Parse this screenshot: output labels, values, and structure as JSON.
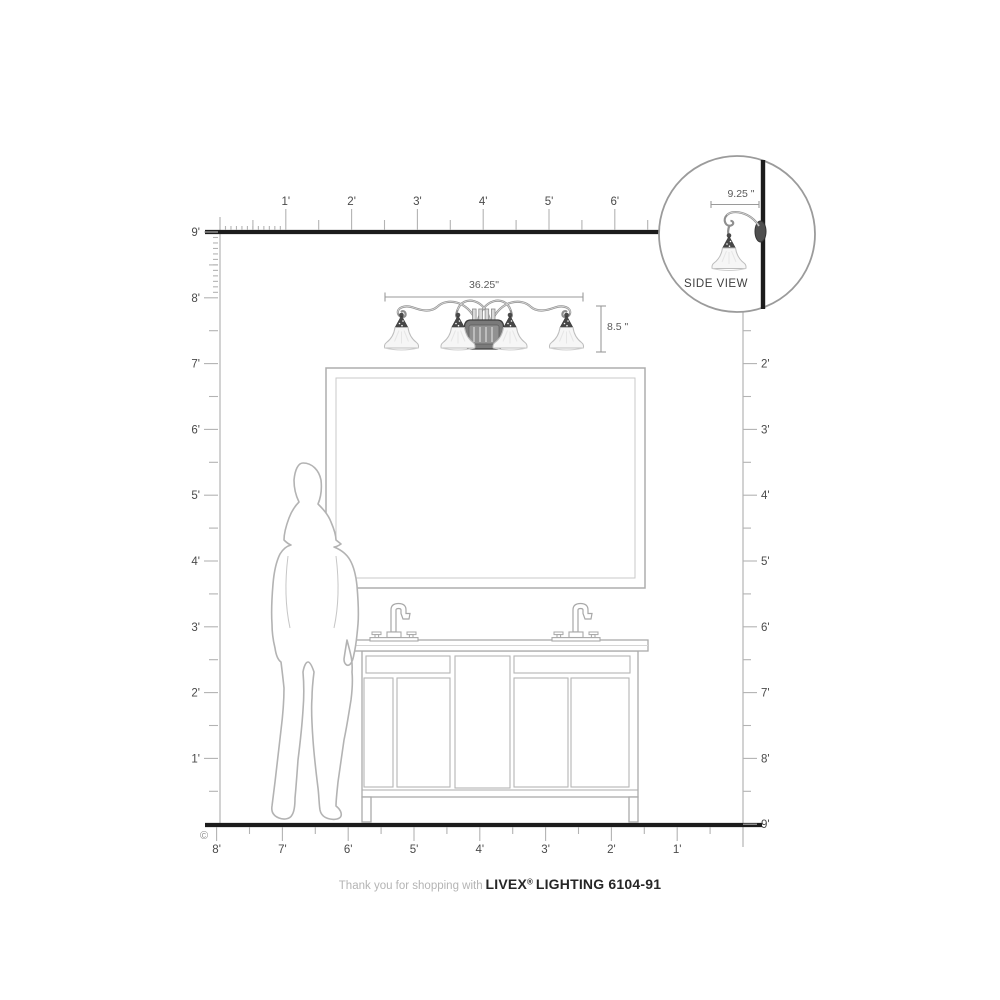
{
  "page": {
    "background": "#ffffff",
    "wall_line_color": "#1c1c1c",
    "ruler_line_color": "#b3b3b3",
    "ruler_label_color": "#4a4a4a",
    "drawing_line_color": "#ababab",
    "dim_text_color": "#5a5a5a"
  },
  "rulers": {
    "top": {
      "labels": [
        "1'",
        "2'",
        "3'",
        "4'",
        "5'",
        "6'"
      ]
    },
    "left": {
      "labels": [
        "9'",
        "8'",
        "7'",
        "6'",
        "5'",
        "4'",
        "3'",
        "2'",
        "1'"
      ]
    },
    "right": {
      "labels": [
        "2'",
        "3'",
        "4'",
        "5'",
        "6'",
        "7'",
        "8'",
        "9'"
      ]
    },
    "bottom": {
      "labels": [
        "8'",
        "7'",
        "6'",
        "5'",
        "4'",
        "3'",
        "2'",
        "1'"
      ]
    }
  },
  "dimensions": {
    "fixture_width": "36.25\"",
    "fixture_height": "8.5 \"",
    "side_depth": "9.25 \""
  },
  "side_view": {
    "label": "SIDE VIEW"
  },
  "copyright": "©",
  "footer": {
    "prefix": "Thank you for shopping with",
    "brand": "LIVEX",
    "registered": "®",
    "suffix": " LIGHTING 6104-91"
  }
}
